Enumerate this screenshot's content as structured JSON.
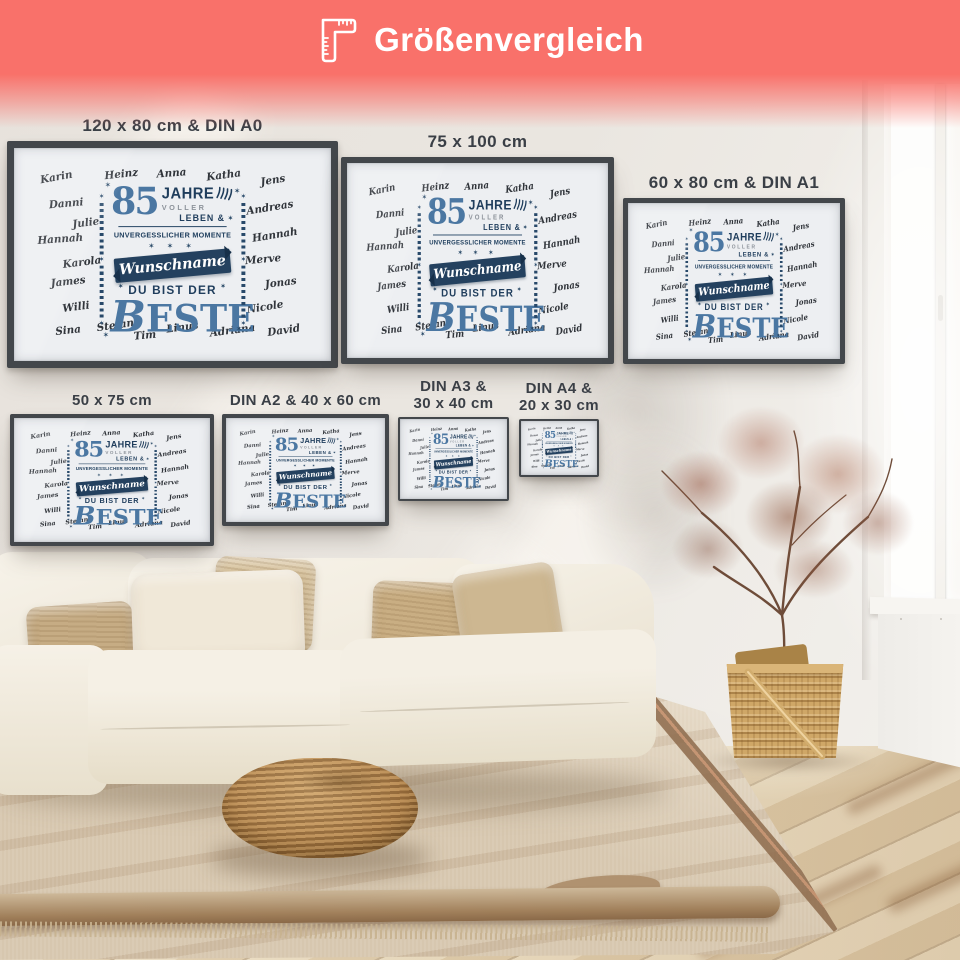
{
  "header": {
    "title": "Größenvergleich",
    "icon": "corner-ruler-icon",
    "background_color": "#f9716a",
    "text_color": "#ffffff"
  },
  "posters": [
    {
      "size_label": [
        "120 x 80 cm & DIN A0"
      ]
    },
    {
      "size_label": [
        "75 x 100 cm"
      ]
    },
    {
      "size_label": [
        "60 x 80 cm & DIN A1"
      ]
    },
    {
      "size_label": [
        "50 x 75 cm"
      ]
    },
    {
      "size_label": [
        "DIN A2 & 40 x 60 cm"
      ]
    },
    {
      "size_label": [
        "DIN A3 &",
        "30 x 40 cm"
      ]
    },
    {
      "size_label": [
        "DIN A4 &",
        "20 x 30 cm"
      ]
    }
  ],
  "poster_design": {
    "names": [
      "Karin",
      "Heinz",
      "Anna",
      "Katha",
      "Jens",
      "Danni",
      "Andreas",
      "Julie",
      "Hannah",
      "Hannah",
      "Karola",
      "Merve",
      "James",
      "Jonas",
      "Willi",
      "Nicole",
      "Sina",
      "Stefan",
      "Tim",
      "Linus",
      "Adriana",
      "David"
    ],
    "age": "85",
    "word_jahre": "JAHRE",
    "word_voller": "VOLLER",
    "word_leben": "LEBEN &",
    "word_moments": "UNVERGESSLICHER MOMENTE",
    "ribbon": "Wunschname",
    "word_du_bist_der": "DU BIST DER",
    "word_beste": "BESTE",
    "colors": {
      "steel_blue": "#4b77a2",
      "navy": "#1f3d5c",
      "gray": "#8d939b",
      "paper": "#edeff2",
      "frame": "#43474b"
    }
  },
  "decor": {
    "star": "✶",
    "stars_row": "✶ ✶ ✶"
  },
  "palette": {
    "wall": "#e9e5e0",
    "floor_wood": "#e0cfae",
    "rug": "#d7c7af",
    "rug_border": "#8d6a4b",
    "sofa": "#f3eee3",
    "pillow_beige": "#c6ac84",
    "pouf_rattan": "#b3834b",
    "basket": "#cfa767",
    "label_text": "#3a3f46"
  }
}
